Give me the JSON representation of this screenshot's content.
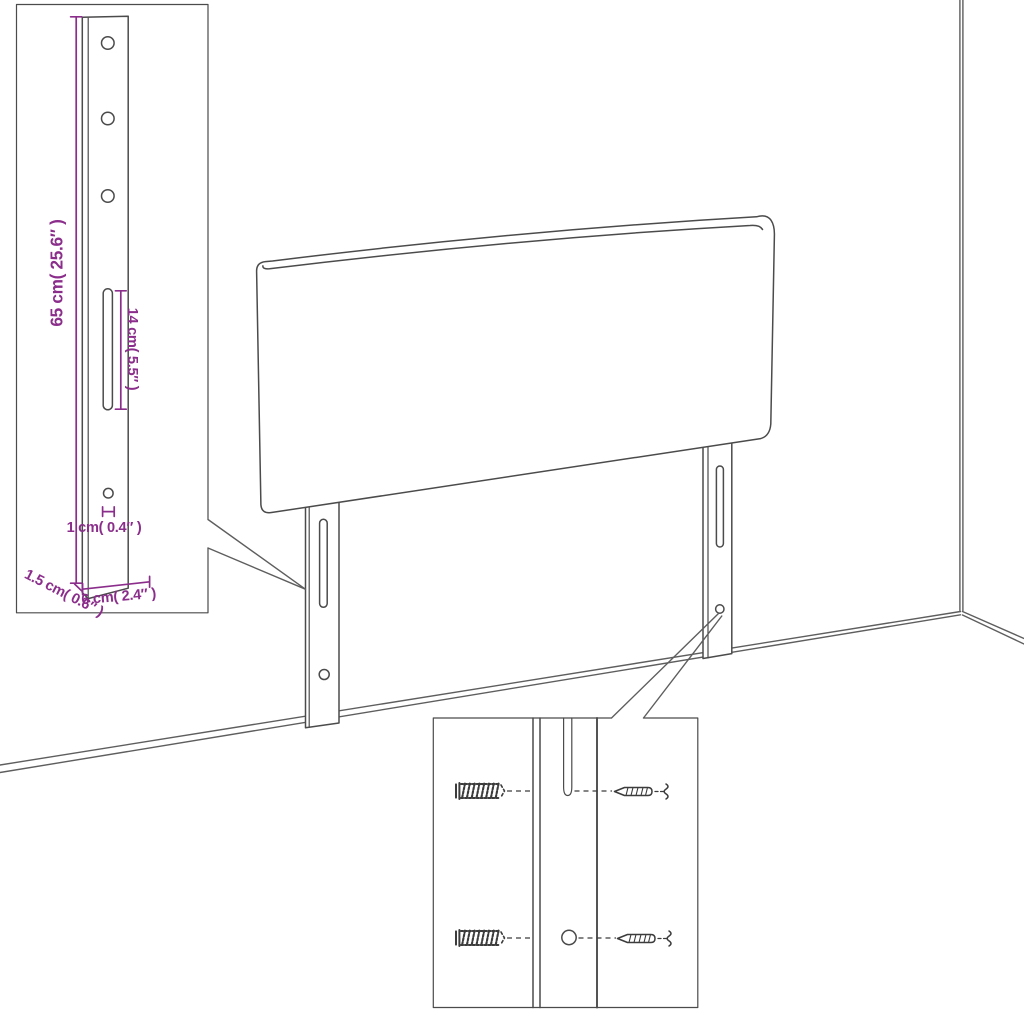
{
  "colors": {
    "line": "#4b4b4b",
    "wall": "#5e5e5e",
    "dimension": "#8b2e8b",
    "hardware": "#3c3c3c",
    "background": "#ffffff"
  },
  "diagram": {
    "subject": "headboard-assembly-diagram",
    "leg_detail": {
      "height_label": "65 cm( 25.6″ )",
      "slot_label": "14 cm( 5.5″ )",
      "hole_label": "1 cm( 0.4″ )",
      "thickness_label": "1.5 cm( 0.6″ )",
      "width_label": "6 cm( 2.4″ )"
    },
    "mounting_detail": {
      "hardware_icons": [
        "wall-plug-icon",
        "screw-icon"
      ]
    }
  }
}
